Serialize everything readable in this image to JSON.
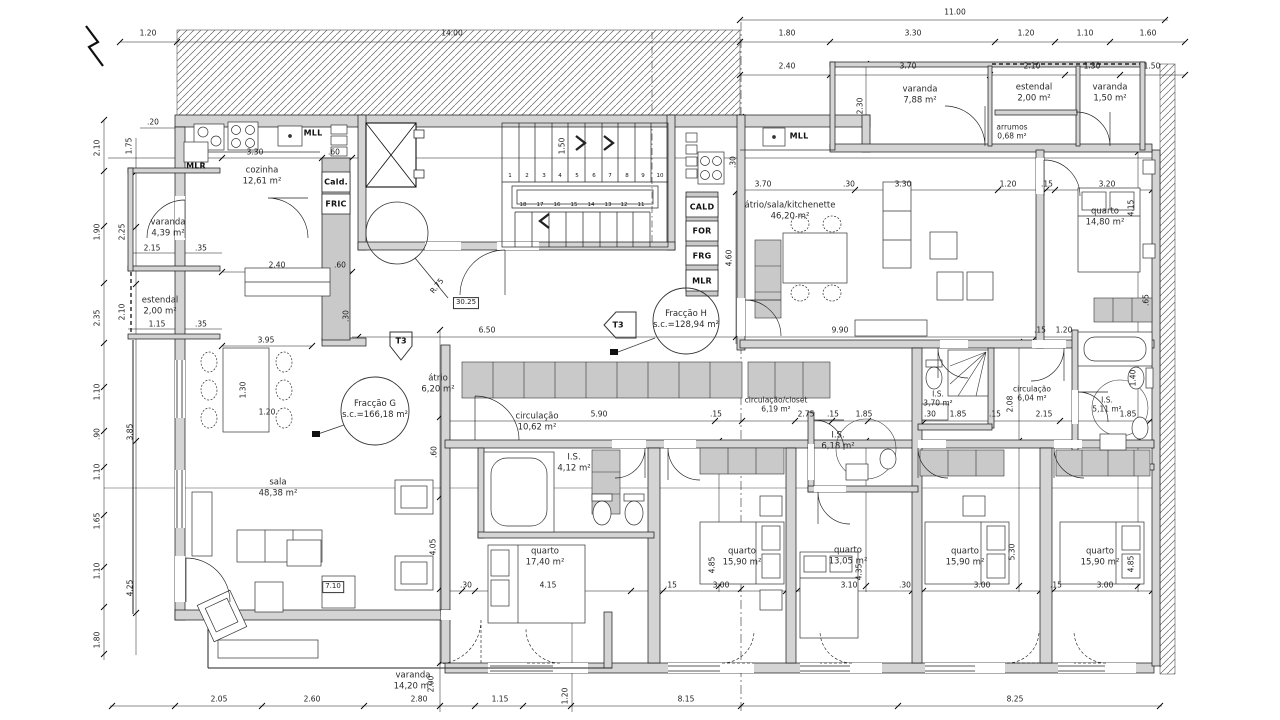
{
  "fractions": {
    "g": {
      "name": "Fracção G",
      "area": "s.c.=166,18 m²"
    },
    "h": {
      "name": "Fracção H",
      "area": "s.c.=128,94 m²"
    }
  },
  "rooms": {
    "cozinha": {
      "name": "cozinha",
      "area": "12,61 m²"
    },
    "varanda_g": {
      "name": "varanda",
      "area": "4,39 m²"
    },
    "estendal_g": {
      "name": "estendal",
      "area": "2,00 m²"
    },
    "sala": {
      "name": "sala",
      "area": "48,38 m²"
    },
    "atrio_g": {
      "name": "átrio",
      "area": "6,20 m²"
    },
    "circulacao_g": {
      "name": "circulação",
      "area": "10,62 m²"
    },
    "is_g": {
      "name": "I.S.",
      "area": "4,12 m²"
    },
    "quarto_g1": {
      "name": "quarto",
      "area": "17,40 m²"
    },
    "quarto_g2": {
      "name": "quarto",
      "area": "15,90 m²"
    },
    "quarto_g3": {
      "name": "quarto",
      "area": "13,05 m²"
    },
    "is_mid": {
      "name": "I.S.",
      "area": "6,18 m²"
    },
    "closet": {
      "name": "circulação/closet",
      "area": "6,19 m²"
    },
    "varanda_g2": {
      "name": "varanda",
      "area": "14,20 m²"
    },
    "sala_h": {
      "name": "átrio/sala/kitchenette",
      "area": "46,20 m²"
    },
    "varanda_h1": {
      "name": "varanda",
      "area": "7,88 m²"
    },
    "estendal_h": {
      "name": "estendal",
      "area": "2,00 m²"
    },
    "varanda_h2": {
      "name": "varanda",
      "area": "1,50 m²"
    },
    "arrumos": {
      "name": "arrumos",
      "area": "0,68 m²"
    },
    "quarto_h1": {
      "name": "quarto",
      "area": "14,80 m²"
    },
    "is_h1": {
      "name": "I.S.",
      "area": "3,70 m²"
    },
    "circulacao_h": {
      "name": "circulação",
      "area": "6,04 m²"
    },
    "is_h2": {
      "name": "I.S.",
      "area": "5,11 m²"
    },
    "quarto_h2": {
      "name": "quarto",
      "area": "15,90 m²"
    },
    "quarto_h3": {
      "name": "quarto",
      "area": "15,90 m²"
    }
  },
  "appliances": {
    "mlr_left": "MLR",
    "mll_left": "MLL",
    "cald_left": "Cald.",
    "fric": "FRIC",
    "cald": "CALD",
    "for": "FOR",
    "frg": "FRG",
    "mlr_mid": "MLR",
    "mll_right": "MLL"
  },
  "stairs": {
    "up": [
      "1",
      "2",
      "3",
      "4",
      "5",
      "6",
      "7",
      "8",
      "9",
      "10"
    ],
    "down": [
      "18",
      "17",
      "16",
      "15",
      "14",
      "13",
      "12",
      "11"
    ]
  },
  "markers": {
    "t3_g": "T3",
    "t3_h": "T3",
    "lvl_core": "30.25",
    "lvl_sala": "7.10",
    "radius": "R.75"
  },
  "dims": {
    "t_120": "1.20",
    "t_1400": "14.00",
    "t_1100": "11.00",
    "t_180": "1.80",
    "t_330": "3.30",
    "t_120b": "1.20",
    "t_110": "1.10",
    "t_160": "1.60",
    "t_240": "2.40",
    "t_370": "3.70",
    "t_210": "2.10",
    "t_130": "1.30",
    "t_150": "1.50",
    "t_230": "2.30",
    "l_210": "2.10",
    "l_190": "1.90",
    "l_235": "2.35",
    "l_110a": "1.10",
    "l_090": ".90",
    "l_110b": "1.10",
    "l_165": "1.65",
    "l_110c": "1.10",
    "l_180": "1.80",
    "l_175": "1.75",
    "l_225": "2.25",
    "l_210b": "2.10",
    "l_385": "3.85",
    "l_425": "4.25",
    "l_020": ".20",
    "l_215": "2.15",
    "l_035a": ".35",
    "l_115": "1.15",
    "l_035b": ".35",
    "k_330": "3.30",
    "k_060a": ".60",
    "k_240": "2.40",
    "k_060b": ".60",
    "k_030": ".30",
    "d_395": "3.95",
    "d_130": "1.30",
    "d_120": "1.20",
    "c_650": "6.50",
    "c_990": "9.90",
    "c_030": ".30",
    "c_150": "1.50",
    "h_590": "5.90",
    "h_015": ".15",
    "h_060": ".60",
    "r_370": "3.70",
    "r_030": ".30",
    "r_330": "3.30",
    "r_120": "1.20",
    "r_015": ".15",
    "r_320": "3.20",
    "r_460": "4.60",
    "r_415": "4.15",
    "r_065": ".65",
    "r_140": "1.40",
    "m_015": ".15",
    "m_120": "1.20",
    "m_208": "2.08",
    "m_215": "2.15",
    "m_185": "1.85",
    "cl_275": "2.75",
    "cl_015": ".15",
    "cl_185": "1.85",
    "cl_030": ".30",
    "cl_185b": "1.85",
    "cl_015b": ".15",
    "b_030": ".30",
    "b_415": "4.15",
    "b_015": ".15",
    "b_300a": "3.00",
    "b_310": "3.10",
    "b_030b": ".30",
    "b_300b": "3.00",
    "b_015b": ".15",
    "b_300c": "3.00",
    "b_485a": "4.85",
    "b_435": "4.35",
    "b_530": "5.30",
    "b_485b": "4.85",
    "b_405": "4.05",
    "v_200": "2.00",
    "v_120": "1.20",
    "bt_205": "2.05",
    "bt_260": "2.60",
    "bt_280": "2.80",
    "bt_115": "1.15",
    "bt_815": "8.15",
    "bt_825": "8.25"
  }
}
